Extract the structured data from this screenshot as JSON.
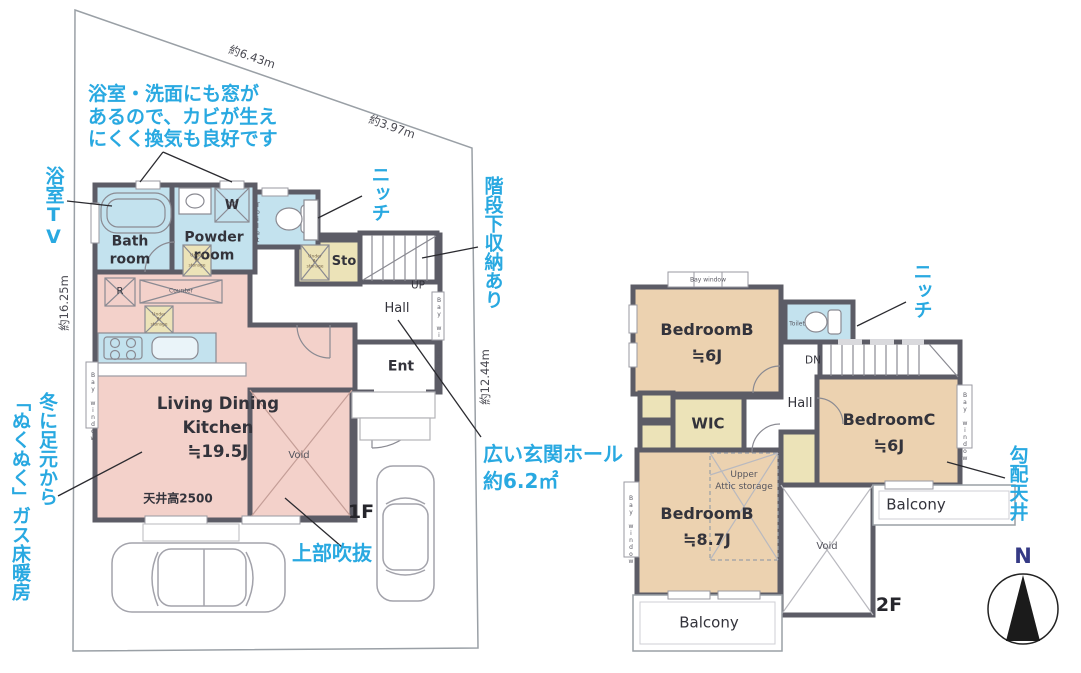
{
  "colors": {
    "annotation": "#29a9e1",
    "wall": "#5c5c66",
    "room_pink": "#f3d1ca",
    "room_tan": "#ecd2b0",
    "room_cyan": "#c3e2ee",
    "room_yellow": "#ece3b8",
    "north_label": "#353a85"
  },
  "dims": {
    "top": "約6.43m",
    "top_right": "約3.97m",
    "left": "約16.25m",
    "right": "約12.44m"
  },
  "f1": {
    "floor": "1F",
    "bath": "Bath\nroom",
    "powder": "Powder\nroom",
    "toilet": "Toilet",
    "washer": "W",
    "fridge": "R",
    "counter": "Counter",
    "under_floor": "Under\nflr\nstorage",
    "sto": "Sto",
    "up": "UP",
    "hall": "Hall",
    "ent": "Ent",
    "ldk": "Living Dining\nKitchen\n≒19.5J",
    "ceiling": "天井高2500",
    "void": "Void",
    "bay_window": "Bay window"
  },
  "f2": {
    "floor": "2F",
    "bedroom_b6": "BedroomB\n≒6J",
    "bedroom_b87": "BedroomB\n≒8.7J",
    "bedroom_c": "BedroomC\n≒6J",
    "wic": "WIC",
    "hall": "Hall",
    "toilet": "Toilet",
    "dn": "DN",
    "attic": "Upper\nAttic storage",
    "void": "Void",
    "balcony_bottom": "Balcony",
    "balcony_right": "Balcony",
    "bay_window": "Bay window"
  },
  "annotations": {
    "bath_window": "浴室・洗面にも窓が\nあるので、カビが生え\nにくく換気も良好です",
    "bath_tv": "浴室TV",
    "niche_1f": "ニッチ",
    "under_stairs": "階段下収納あり",
    "entrance_hall": "広い玄関ホール\n約6.2㎡",
    "void_above": "上部吹抜",
    "floor_heating": "冬に足元から\n「ぬくぬく」ガス床暖房",
    "niche_2f": "ニッチ",
    "sloped_ceiling": "勾配天井"
  },
  "compass": {
    "north": "N"
  }
}
